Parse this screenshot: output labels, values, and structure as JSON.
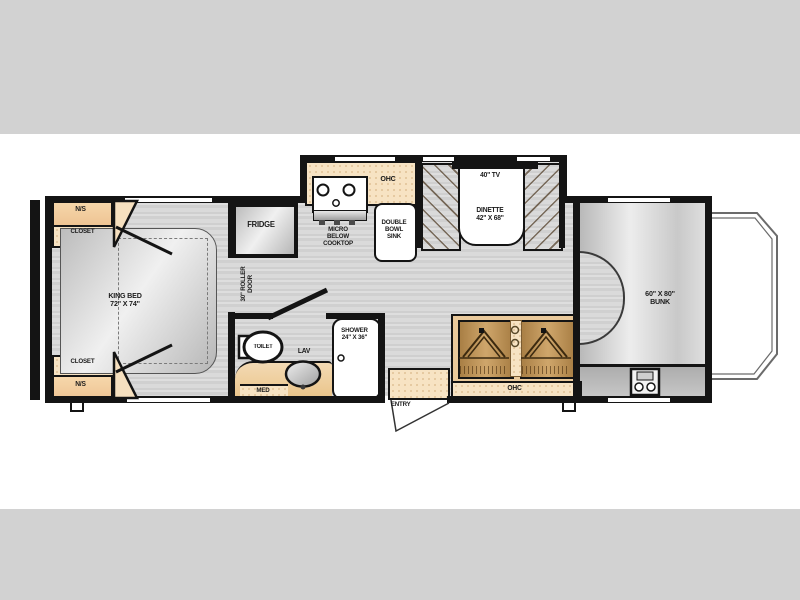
{
  "page": {
    "type": "rv-floorplan",
    "colors": {
      "background": "#ffffff",
      "letterbox_bar": "#d2d2d2",
      "wall": "#141414",
      "floor_wood": "#d6d6d6",
      "cabinet_cream": "#f7e3c3",
      "cabinet_peach": "#f2cda0",
      "bench_brown": "#b3874e",
      "appliance_silver": "#d9d9d9",
      "fixture_white": "#ffffff"
    }
  },
  "labels": {
    "ns_top": "N/S",
    "closet_top": "CLOSET",
    "ns_bottom": "N/S",
    "closet_bottom": "CLOSET",
    "king_bed": {
      "l1": "KING BED",
      "l2": "72\" X 74\""
    },
    "fridge": "FRIDGE",
    "roller_door": {
      "l1": "30\" ROLLER",
      "l2": "DOOR"
    },
    "kitchen_ohc": "OHC",
    "micro": {
      "l1": "MICRO",
      "l2": "BELOW",
      "l3": "COOKTOP"
    },
    "sink": {
      "l1": "DOUBLE",
      "l2": "BOWL",
      "l3": "SINK"
    },
    "tv": "40\" TV",
    "dinette": {
      "l1": "DINETTE",
      "l2": "42\" X 68\""
    },
    "toilet": "TOILET",
    "lav": "LAV",
    "med": "MED",
    "shower": {
      "l1": "SHOWER",
      "l2": "24\" X 36\""
    },
    "entry": "ENTRY",
    "living_ohc": "OHC",
    "bunk": {
      "l1": "60\" X 80\"",
      "l2": "BUNK"
    }
  }
}
